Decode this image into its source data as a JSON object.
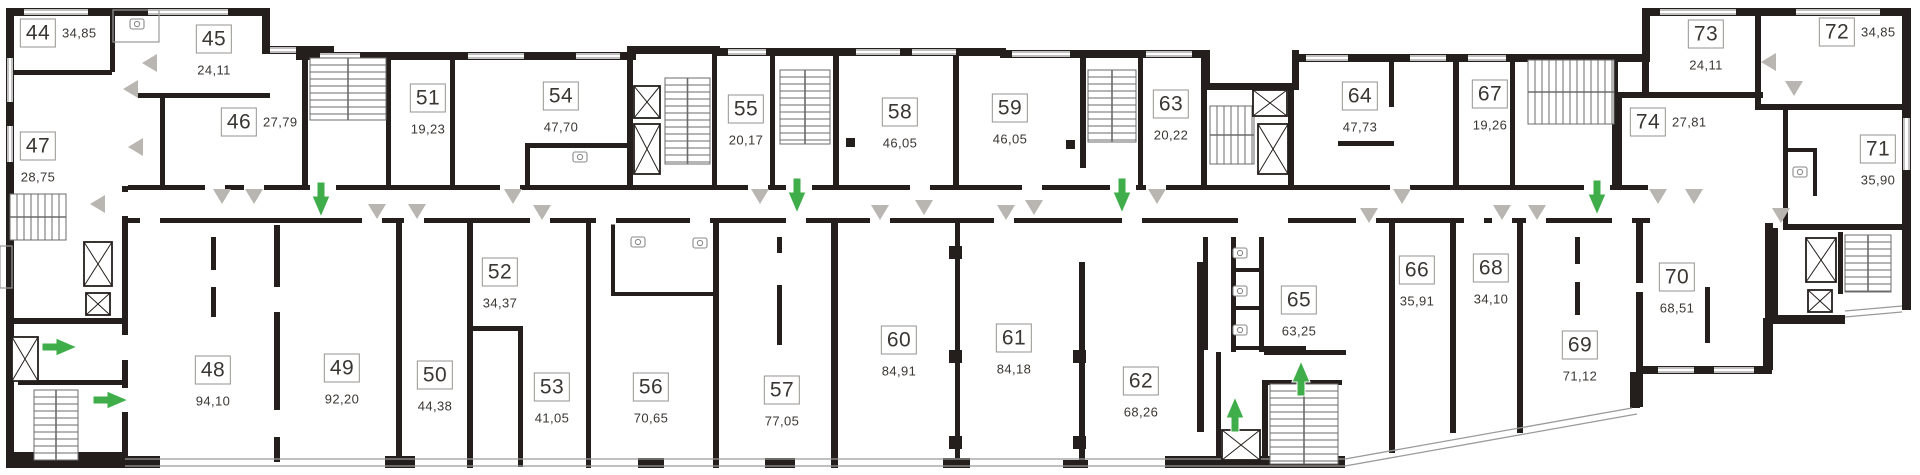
{
  "meta": {
    "kind": "residential-floor-plan"
  },
  "colors": {
    "wall": "#241f1c",
    "entrance_arrow_green": "#3fae4a",
    "door_marker_gray": "#b9b5b1",
    "thin_line_gray": "#9a9a9a",
    "stair_line_gray": "#6b6b6b",
    "label_border": "#97938f",
    "text": "#3a3633"
  },
  "units": [
    {
      "number": "44",
      "area": "34,85",
      "x": 38,
      "y": 33,
      "area_pos": "right"
    },
    {
      "number": "45",
      "area": "24,11",
      "x": 214,
      "y": 39,
      "area_pos": "below"
    },
    {
      "number": "46",
      "area": "27,79",
      "x": 239,
      "y": 122,
      "area_pos": "right"
    },
    {
      "number": "47",
      "area": "28,75",
      "x": 38,
      "y": 146,
      "area_pos": "below"
    },
    {
      "number": "48",
      "area": "94,10",
      "x": 213,
      "y": 370,
      "area_pos": "below"
    },
    {
      "number": "49",
      "area": "92,20",
      "x": 342,
      "y": 368,
      "area_pos": "below"
    },
    {
      "number": "50",
      "area": "44,38",
      "x": 435,
      "y": 375,
      "area_pos": "below"
    },
    {
      "number": "51",
      "area": "19,23",
      "x": 428,
      "y": 98,
      "area_pos": "below"
    },
    {
      "number": "52",
      "area": "34,37",
      "x": 500,
      "y": 272,
      "area_pos": "below"
    },
    {
      "number": "53",
      "area": "41,05",
      "x": 552,
      "y": 387,
      "area_pos": "below"
    },
    {
      "number": "54",
      "area": "47,70",
      "x": 561,
      "y": 96,
      "area_pos": "below"
    },
    {
      "number": "55",
      "area": "20,17",
      "x": 746,
      "y": 109,
      "area_pos": "below"
    },
    {
      "number": "56",
      "area": "70,65",
      "x": 651,
      "y": 387,
      "area_pos": "below"
    },
    {
      "number": "57",
      "area": "77,05",
      "x": 782,
      "y": 390,
      "area_pos": "below"
    },
    {
      "number": "58",
      "area": "46,05",
      "x": 900,
      "y": 112,
      "area_pos": "below"
    },
    {
      "number": "59",
      "area": "46,05",
      "x": 1010,
      "y": 108,
      "area_pos": "below"
    },
    {
      "number": "60",
      "area": "84,91",
      "x": 899,
      "y": 340,
      "area_pos": "below"
    },
    {
      "number": "61",
      "area": "84,18",
      "x": 1014,
      "y": 338,
      "area_pos": "below"
    },
    {
      "number": "62",
      "area": "68,26",
      "x": 1141,
      "y": 381,
      "area_pos": "below"
    },
    {
      "number": "63",
      "area": "20,22",
      "x": 1171,
      "y": 104,
      "area_pos": "below"
    },
    {
      "number": "64",
      "area": "47,73",
      "x": 1360,
      "y": 96,
      "area_pos": "below"
    },
    {
      "number": "65",
      "area": "63,25",
      "x": 1299,
      "y": 300,
      "area_pos": "below"
    },
    {
      "number": "66",
      "area": "35,91",
      "x": 1417,
      "y": 270,
      "area_pos": "below"
    },
    {
      "number": "67",
      "area": "19,26",
      "x": 1490,
      "y": 94,
      "area_pos": "below"
    },
    {
      "number": "68",
      "area": "34,10",
      "x": 1491,
      "y": 268,
      "area_pos": "below"
    },
    {
      "number": "69",
      "area": "71,12",
      "x": 1580,
      "y": 345,
      "area_pos": "below"
    },
    {
      "number": "70",
      "area": "68,51",
      "x": 1677,
      "y": 277,
      "area_pos": "below"
    },
    {
      "number": "71",
      "area": "35,90",
      "x": 1878,
      "y": 149,
      "area_pos": "below"
    },
    {
      "number": "72",
      "area": "34,85",
      "x": 1837,
      "y": 32,
      "area_pos": "right"
    },
    {
      "number": "73",
      "area": "24,11",
      "x": 1706,
      "y": 34,
      "area_pos": "below"
    },
    {
      "number": "74",
      "area": "27,81",
      "x": 1648,
      "y": 122,
      "area_pos": "right"
    }
  ],
  "entrance_arrows": [
    {
      "dir": "right",
      "x": 60,
      "y": 347
    },
    {
      "dir": "right",
      "x": 111,
      "y": 400
    },
    {
      "dir": "down",
      "x": 321,
      "y": 200
    },
    {
      "dir": "down",
      "x": 797,
      "y": 196
    },
    {
      "dir": "down",
      "x": 1122,
      "y": 196
    },
    {
      "dir": "up",
      "x": 1235,
      "y": 414
    },
    {
      "dir": "up",
      "x": 1301,
      "y": 378
    },
    {
      "dir": "down",
      "x": 1597,
      "y": 198
    }
  ]
}
